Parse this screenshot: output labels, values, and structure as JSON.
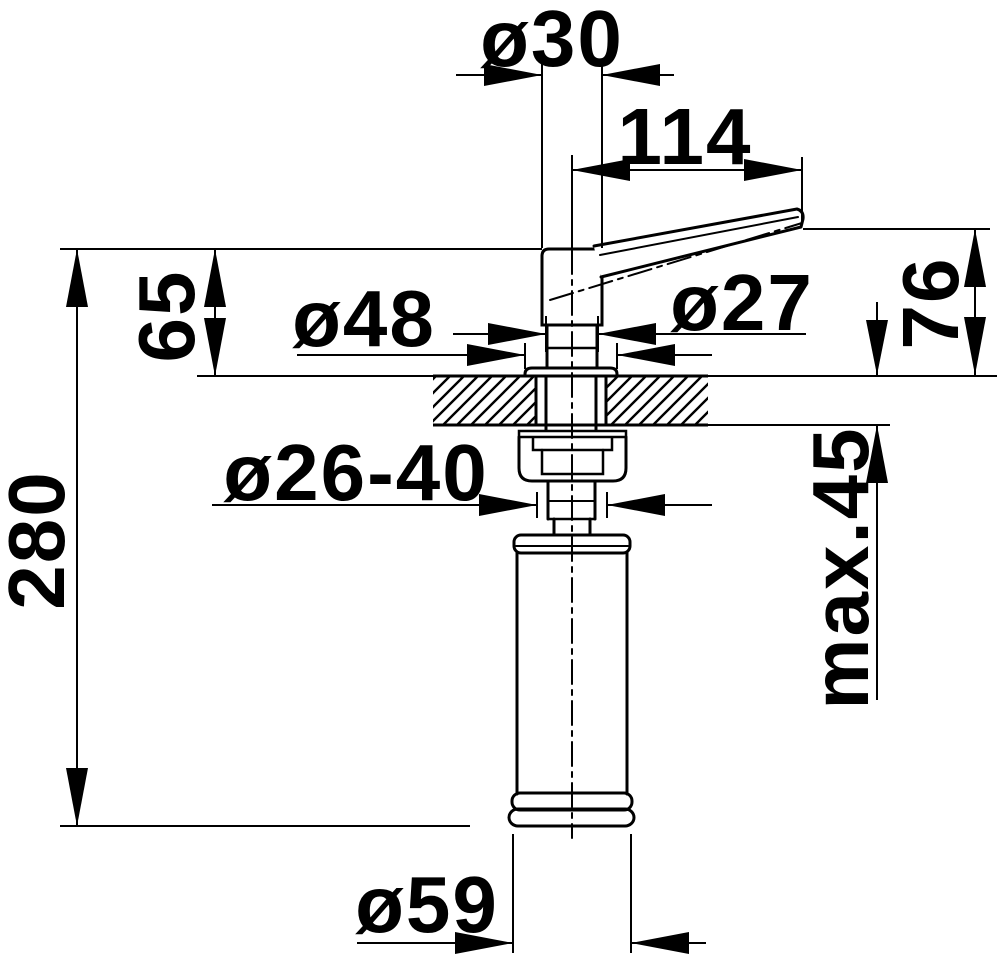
{
  "drawing": {
    "kind": "technical dimension drawing",
    "subject": "countertop soap dispenser, side section view",
    "background_color": "#ffffff",
    "line_color": "#000000",
    "labels": {
      "spout_tube_diameter": "ø30",
      "spout_reach": "114",
      "head_height": "65",
      "flange_diameter": "ø48",
      "neck_diameter": "ø27",
      "spout_height_above_counter": "76",
      "mounting_hole_diameter": "ø26-40",
      "max_counter_thickness": "max.45",
      "overall_height": "280",
      "bottle_diameter": "ø59"
    }
  }
}
